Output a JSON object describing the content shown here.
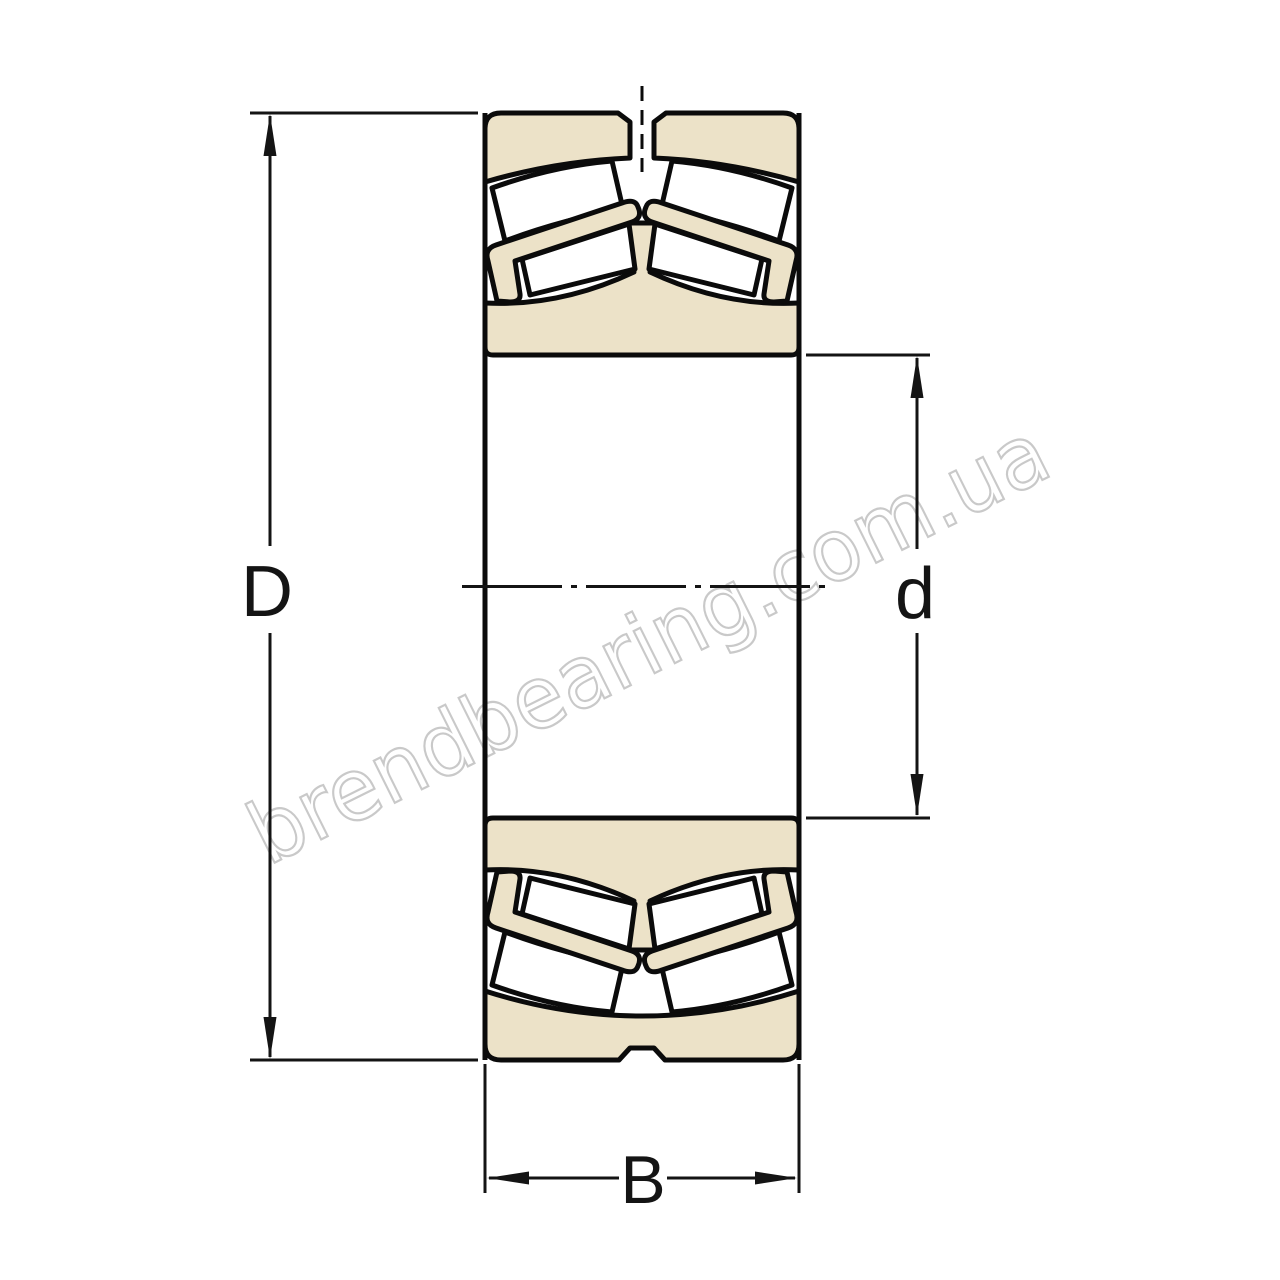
{
  "diagram": {
    "kind": "spherical-roller-bearing-cross-section",
    "labels": {
      "outer_diameter": "D",
      "bore_diameter": "d",
      "width": "B"
    }
  },
  "watermark": {
    "text": "brendbearing.com.ua",
    "color": "#c9c9c9"
  },
  "colors": {
    "ring_fill": "#ece2c8",
    "roller_fill": "#ffffff",
    "outline": "#0b0b0b",
    "dimension": "#141414",
    "background": "#ffffff"
  }
}
